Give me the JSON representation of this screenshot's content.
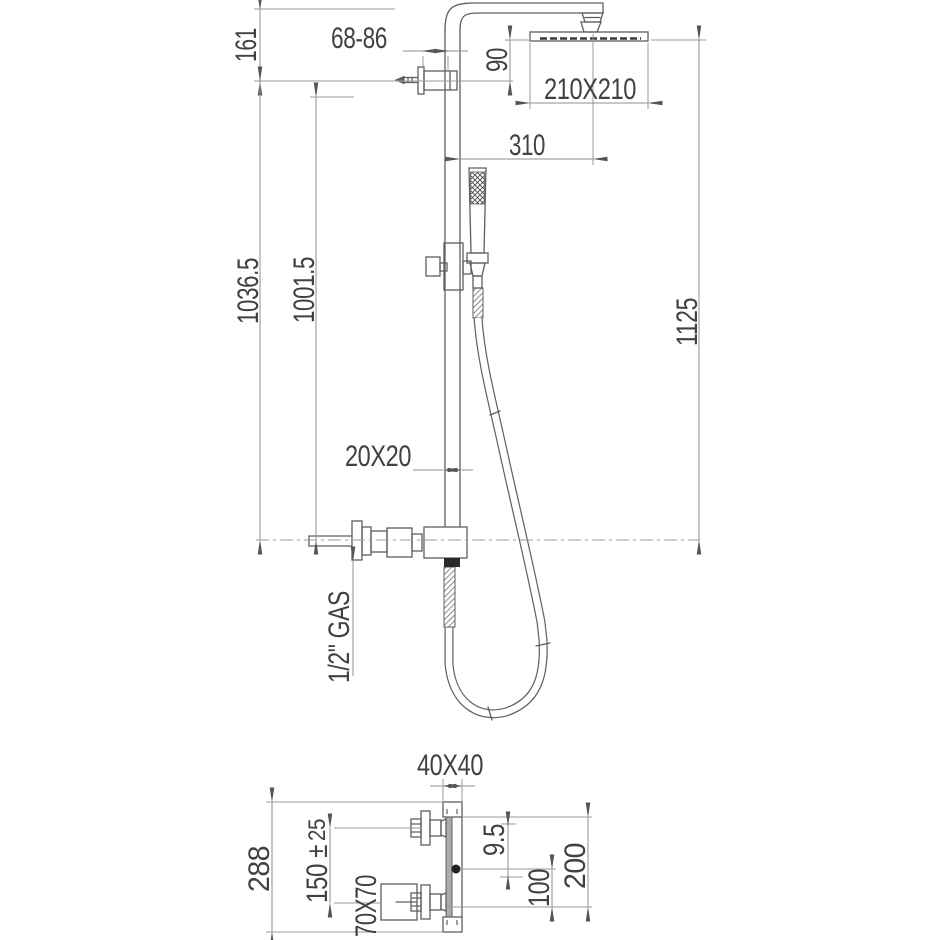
{
  "title": "Shower column technical drawing",
  "labels": {
    "d161": "161",
    "d6886": "68-86",
    "d90": "90",
    "d210": "210X210",
    "d310": "310",
    "d1036": "1036.5",
    "d1001": "1001.5",
    "d1125": "1125",
    "d2020": "20X20",
    "gas": "1/2\" GAS",
    "d4040": "40X40",
    "d288": "288",
    "d150": "150 ±",
    "d25": "25",
    "d7070": "70X70",
    "d95": "9.5",
    "d100": "100",
    "d200": "200"
  },
  "dimensions_mm": {
    "front_view": [
      "161",
      "68-86",
      "90",
      "210X210",
      "310",
      "1036.5",
      "1001.5",
      "1125",
      "20X20",
      "1/2\" GAS"
    ],
    "bottom_view": [
      "40X40",
      "288",
      "150 ± 25",
      "70X70",
      "9.5",
      "100",
      "200"
    ]
  },
  "parts": [
    "overhead-rain-shower-head",
    "shower-arm",
    "ball-joint",
    "wall-bracket",
    "vertical-column",
    "hand-shower",
    "slider-holder",
    "flexible-hose",
    "diverter-valve",
    "supply-connection",
    "wall-plate",
    "outlet"
  ],
  "colors": {
    "background": "#ffffff",
    "part_line": "#5f5f5f",
    "dimension_line": "#8f8f8f",
    "text": "#414141",
    "wall_plate_fill": "#ababab",
    "outlet_fill": "#222222"
  }
}
